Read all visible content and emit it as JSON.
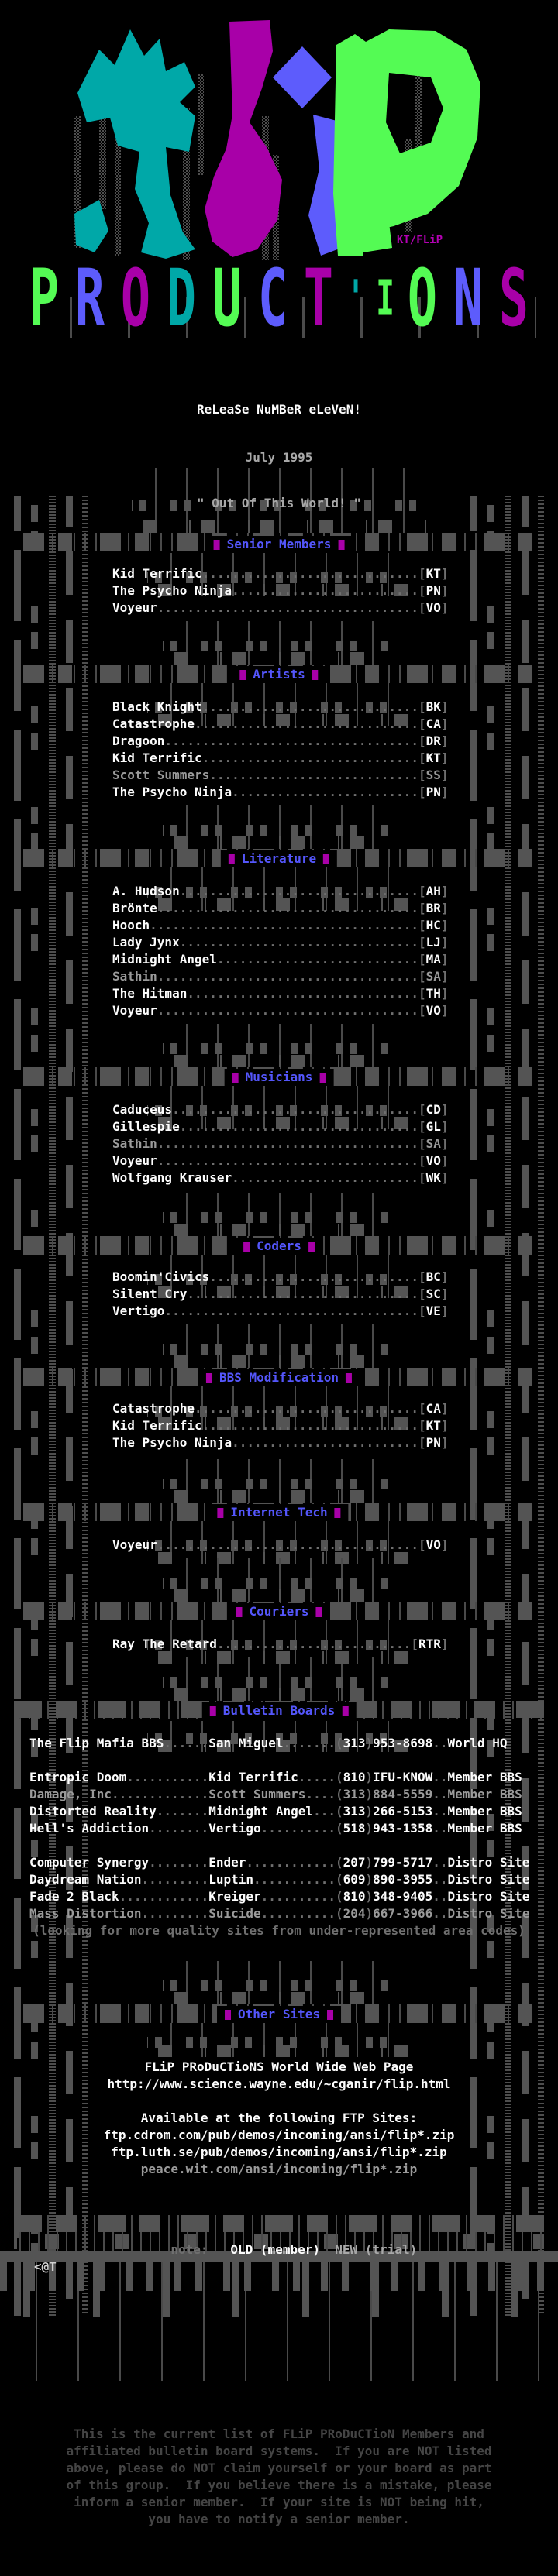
{
  "palette": {
    "gray_block": "#545454",
    "white": "#fcfcfc",
    "dim": "#9a9a9a",
    "leader_dots": "#6f6f6f",
    "header_blue": "#5456fb",
    "magenta": "#a800a8",
    "green": "#54fb54",
    "teal": "#00a8a8",
    "blue": "#5d5cfc",
    "footer_gray": "#454545"
  },
  "logo": {
    "group_name": "FLiP",
    "signature": "KT/FLiP",
    "word": "PRODUCTIONS",
    "word_letters": [
      {
        "ch": "P",
        "color": "#54fb54"
      },
      {
        "ch": "R",
        "color": "#5d5cfc"
      },
      {
        "ch": "O",
        "color": "#a800a8"
      },
      {
        "ch": "D",
        "color": "#00a8a8"
      },
      {
        "ch": "U",
        "color": "#54fb54"
      },
      {
        "ch": "C",
        "color": "#5d5cfc"
      },
      {
        "ch": "T",
        "color": "#a800a8"
      },
      {
        "ch": "'",
        "color": "#00a8a8",
        "narrow": true
      },
      {
        "ch": "I",
        "color": "#54fb54",
        "narrow": true
      },
      {
        "ch": "O",
        "color": "#54fb54"
      },
      {
        "ch": "N",
        "color": "#5d5cfc"
      },
      {
        "ch": "S",
        "color": "#a800a8"
      }
    ]
  },
  "release": {
    "title": "ReLeaSe NuMBeR eLeVeN!",
    "date": "July 1995",
    "tagline": "\" Out Of This World! \""
  },
  "sections": [
    {
      "id": "senior-members",
      "label": "Senior Members",
      "entries": [
        {
          "name": "Kid Terrific",
          "tag": "KT",
          "dim": false
        },
        {
          "name": "The Psycho Ninja",
          "tag": "PN",
          "dim": false
        },
        {
          "name": "Voyeur",
          "tag": "VO",
          "dim": false
        }
      ]
    },
    {
      "id": "artists",
      "label": "Artists",
      "entries": [
        {
          "name": "Black Knight",
          "tag": "BK",
          "dim": false
        },
        {
          "name": "Catastrophe",
          "tag": "CA",
          "dim": false
        },
        {
          "name": "Dragoon",
          "tag": "DR",
          "dim": false
        },
        {
          "name": "Kid Terrific",
          "tag": "KT",
          "dim": false
        },
        {
          "name": "Scott Summers",
          "tag": "SS",
          "dim": true
        },
        {
          "name": "The Psycho Ninja",
          "tag": "PN",
          "dim": false
        }
      ]
    },
    {
      "id": "literature",
      "label": "Literature",
      "entries": [
        {
          "name": "A. Hudson",
          "tag": "AH",
          "dim": false
        },
        {
          "name": "Brönte",
          "tag": "BR",
          "dim": false
        },
        {
          "name": "Hooch",
          "tag": "HC",
          "dim": false
        },
        {
          "name": "Lady Jynx",
          "tag": "LJ",
          "dim": false
        },
        {
          "name": "Midnight Angel",
          "tag": "MA",
          "dim": false
        },
        {
          "name": "Sathin",
          "tag": "SA",
          "dim": true
        },
        {
          "name": "The Hitman",
          "tag": "TH",
          "dim": false
        },
        {
          "name": "Voyeur",
          "tag": "VO",
          "dim": false
        }
      ]
    },
    {
      "id": "musicians",
      "label": "Musicians",
      "entries": [
        {
          "name": "Caduceus",
          "tag": "CD",
          "dim": false
        },
        {
          "name": "Gillespie",
          "tag": "GL",
          "dim": false
        },
        {
          "name": "Sathin",
          "tag": "SA",
          "dim": true
        },
        {
          "name": "Voyeur",
          "tag": "VO",
          "dim": false
        },
        {
          "name": "Wolfgang Krauser",
          "tag": "WK",
          "dim": false
        }
      ]
    },
    {
      "id": "coders",
      "label": "Coders",
      "entries": [
        {
          "name": "Boomin'Civics",
          "tag": "BC",
          "dim": false
        },
        {
          "name": "Silent Cry",
          "tag": "SC",
          "dim": false
        },
        {
          "name": "Vertigo",
          "tag": "VE",
          "dim": false
        }
      ]
    },
    {
      "id": "bbs-modification",
      "label": "BBS Modification",
      "entries": [
        {
          "name": "Catastrophe",
          "tag": "CA",
          "dim": false
        },
        {
          "name": "Kid Terrific",
          "tag": "KT",
          "dim": false
        },
        {
          "name": "The Psycho Ninja",
          "tag": "PN",
          "dim": false
        }
      ]
    },
    {
      "id": "internet-tech",
      "label": "Internet Tech",
      "entries": [
        {
          "name": "Voyeur",
          "tag": "VO",
          "dim": false
        }
      ]
    },
    {
      "id": "couriers",
      "label": "Couriers",
      "entries": [
        {
          "name": "Ray The Retard",
          "tag": "RTR",
          "dim": false
        }
      ]
    }
  ],
  "bulletin_boards": {
    "label": "Bulletin Boards",
    "rows": [
      {
        "board": "The Flip Mafia BBS",
        "sysop": "San Miguel",
        "phone": "(313)953-8698",
        "role": "World HQ",
        "dim": false,
        "group": 0
      },
      {
        "board": "Entropic Doom",
        "sysop": "Kid Terrific",
        "phone": "(810)IFU-KNOW",
        "role": "Member BBS",
        "dim": false,
        "group": 1
      },
      {
        "board": "Damage, Inc",
        "sysop": "Scott Summers",
        "phone": "(313)884-5559",
        "role": "Member BBS",
        "dim": true,
        "group": 1
      },
      {
        "board": "Distorted Reality",
        "sysop": "Midnight Angel",
        "phone": "(313)266-5153",
        "role": "Member BBS",
        "dim": false,
        "group": 1
      },
      {
        "board": "Hell's Addiction",
        "sysop": "Vertigo",
        "phone": "(518)943-1358",
        "role": "Member BBS",
        "dim": false,
        "group": 1
      },
      {
        "board": "Computer Synergy",
        "sysop": "Ender",
        "phone": "(207)799-5717",
        "role": "Distro Site",
        "dim": false,
        "group": 2
      },
      {
        "board": "Daydream Nation",
        "sysop": "Luptin",
        "phone": "(609)890-3955",
        "role": "Distro Site",
        "dim": false,
        "group": 2
      },
      {
        "board": "Fade 2 Black",
        "sysop": "Kreiger",
        "phone": "(810)348-9405",
        "role": "Distro Site",
        "dim": false,
        "group": 2
      },
      {
        "board": "Mass Distortion",
        "sysop": "Suicide",
        "phone": "(204)667-3966",
        "role": "Distro Site",
        "dim": true,
        "group": 2
      }
    ],
    "footnote": "(looking for more quality sites from under-represented area codes)"
  },
  "other_sites": {
    "label": "Other Sites",
    "lines": [
      {
        "text": "FLiP PRoDuCTioNS World Wide Web Page",
        "dim": false
      },
      {
        "text": "http://www.science.wayne.edu/~cganir/flip.html",
        "dim": false
      },
      {
        "text": "",
        "dim": false
      },
      {
        "text": "Available at the following FTP Sites:",
        "dim": false
      },
      {
        "text": "ftp.cdrom.com/pub/demos/incoming/ansi/flip*.zip",
        "dim": false
      },
      {
        "text": "ftp.luth.se/pub/demos/incoming/ansi/flip*.zip",
        "dim": false
      },
      {
        "text": "peace.wit.com/ansi/incoming/flip*.zip",
        "dim": true
      }
    ]
  },
  "legend": {
    "note_label": "note:",
    "old_label": "OLD (member)",
    "new_label": "NEW (trial)"
  },
  "artist_tag": "<@T",
  "footer_lines": [
    "This is the current list of FLiP PRoDuCTioN Members and",
    "affiliated bulletin board systems.  If you are NOT listed",
    "above, please do NOT claim yourself or your board as part",
    "of this group.  If you believe there is a mistake, please",
    "inform a senior member.  If your site is NOT being hit,",
    "you have to notify a senior member."
  ]
}
